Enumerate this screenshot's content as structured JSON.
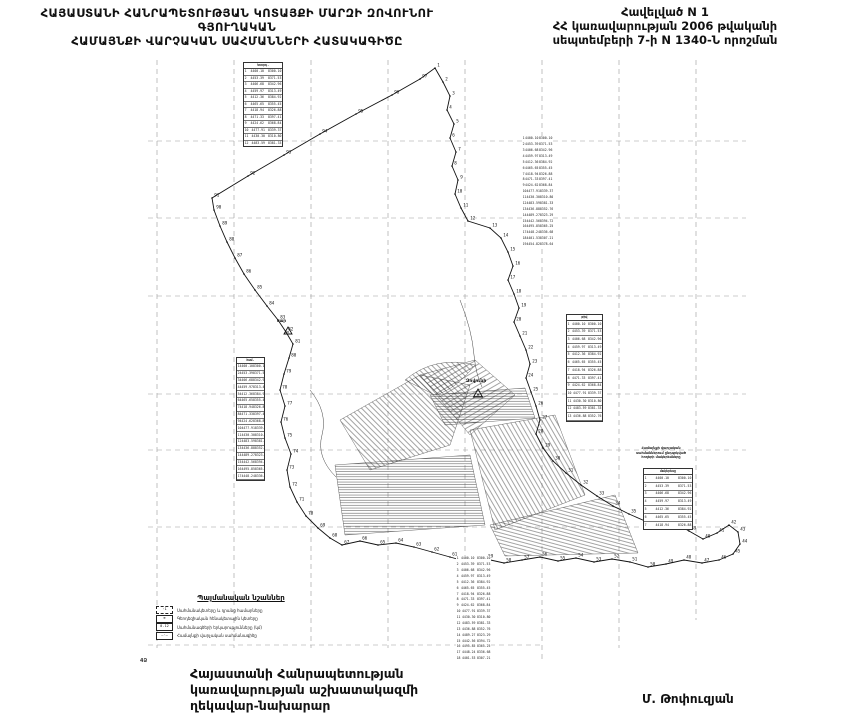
{
  "document": {
    "titles": {
      "left_line1": "ՀԱՅԱՍՏԱՆԻ ՀԱՆՐԱՊԵՏՈՒԹՅԱՆ ԿՈՏԱՅՔԻ ՄԱՐԶԻ ԶՈՎՈՒՆՈՒ ԳՅՈՒՂԱԿԱՆ",
      "left_line2": "ՀԱՄԱՅՆՔԻ ՎԱՐՉԱԿԱՆ ՍԱՀՄԱՆՆԵՐԻ ՀԱՏԱԿԱԳԻԾԸ",
      "right_line1": "Հավելված N 1",
      "right_line2": "ՀՀ կառավարության 2006 թվականի",
      "right_line3": "սեպտեմբերի 7-ի  N 1340-Ն որոշման"
    },
    "footer": {
      "left_line1": "Հայաստանի Հանրապետության",
      "left_line2": "կառավարության աշխատակազմի",
      "left_line3": "ղեկավար-նախարար",
      "signature": "Մ. Թոփուզյան"
    },
    "corner_mark": "4Ձ"
  },
  "legend": {
    "title": "Պայմանական նշաններ",
    "items": [
      {
        "symbol": "boundary-point-box",
        "sample": "·1",
        "label": "Սահմանակետերը և դրանց համարները"
      },
      {
        "symbol": "geodetic-point",
        "sample": "⊕",
        "label": "Գեոդեզիական հենակետային կետերը"
      },
      {
        "symbol": "segment-length",
        "sample": "0.12",
        "label": "Սահմանագծերի երկարությունները (կմ)"
      },
      {
        "symbol": "boundary-line",
        "sample": "—·—",
        "label": "Համայնքի վարչական սահմանագիծը"
      }
    ]
  },
  "map": {
    "settlement_label": "Զովունի",
    "benchmark_label": "սար",
    "note_lines": [
      "Համայնքի վարչական",
      "սահմաններում ընդգրկված",
      "հողերի մակերեսները"
    ],
    "colors": {
      "ink": "#111111",
      "grid": "#9a9a9a"
    },
    "tables": [
      {
        "name": "coord-table-north",
        "x": 243,
        "y": 62,
        "w": 38,
        "h": 83,
        "rows": 14,
        "bordered": true,
        "header": "Կոորդ.",
        "caption": "Զովունի"
      },
      {
        "name": "coord-list-northeast",
        "x": 522,
        "y": 136,
        "w": 31,
        "h": 112,
        "rows": 19,
        "bordered": false,
        "header": "",
        "caption": "ցուցակ"
      },
      {
        "name": "coord-table-east",
        "x": 566,
        "y": 314,
        "w": 35,
        "h": 106,
        "rows": 15,
        "bordered": true,
        "header": "թիվ",
        "caption": "ցուցակ"
      },
      {
        "name": "coord-table-west",
        "x": 236,
        "y": 357,
        "w": 27,
        "h": 122,
        "rows": 20,
        "bordered": true,
        "header": "համ.",
        "caption": "ցուցակ"
      },
      {
        "name": "coord-list-south",
        "x": 456,
        "y": 556,
        "w": 35,
        "h": 106,
        "rows": 18,
        "bordered": false,
        "header": "",
        "caption": ""
      },
      {
        "name": "area-table-southeast",
        "x": 643,
        "y": 468,
        "w": 48,
        "h": 60,
        "rows": 8,
        "bordered": true,
        "header": "մակերեսը",
        "caption": ""
      }
    ],
    "boundary_points": [
      {
        "n": 1,
        "x": 435,
        "y": 68
      },
      {
        "n": 2,
        "x": 443,
        "y": 82
      },
      {
        "n": 3,
        "x": 450,
        "y": 96
      },
      {
        "n": 4,
        "x": 447,
        "y": 110
      },
      {
        "n": 5,
        "x": 454,
        "y": 124
      },
      {
        "n": 6,
        "x": 450,
        "y": 138
      },
      {
        "n": 7,
        "x": 456,
        "y": 152
      },
      {
        "n": 8,
        "x": 452,
        "y": 166
      },
      {
        "n": 9,
        "x": 458,
        "y": 180
      },
      {
        "n": 10,
        "x": 455,
        "y": 194
      },
      {
        "n": 11,
        "x": 461,
        "y": 208
      },
      {
        "n": 12,
        "x": 468,
        "y": 221
      },
      {
        "n": 13,
        "x": 490,
        "y": 228
      },
      {
        "n": 14,
        "x": 501,
        "y": 238
      },
      {
        "n": 15,
        "x": 508,
        "y": 252
      },
      {
        "n": 16,
        "x": 513,
        "y": 266
      },
      {
        "n": 17,
        "x": 508,
        "y": 280
      },
      {
        "n": 18,
        "x": 514,
        "y": 294
      },
      {
        "n": 19,
        "x": 519,
        "y": 308
      },
      {
        "n": 20,
        "x": 514,
        "y": 322
      },
      {
        "n": 21,
        "x": 520,
        "y": 336
      },
      {
        "n": 22,
        "x": 526,
        "y": 350
      },
      {
        "n": 23,
        "x": 530,
        "y": 364
      },
      {
        "n": 24,
        "x": 526,
        "y": 378
      },
      {
        "n": 25,
        "x": 531,
        "y": 392
      },
      {
        "n": 26,
        "x": 536,
        "y": 406
      },
      {
        "n": 27,
        "x": 540,
        "y": 420
      },
      {
        "n": 28,
        "x": 536,
        "y": 434
      },
      {
        "n": 29,
        "x": 543,
        "y": 448
      },
      {
        "n": 30,
        "x": 553,
        "y": 461
      },
      {
        "n": 31,
        "x": 566,
        "y": 473
      },
      {
        "n": 32,
        "x": 581,
        "y": 485
      },
      {
        "n": 33,
        "x": 597,
        "y": 496
      },
      {
        "n": 34,
        "x": 613,
        "y": 506
      },
      {
        "n": 35,
        "x": 629,
        "y": 514
      },
      {
        "n": 36,
        "x": 645,
        "y": 521
      },
      {
        "n": 37,
        "x": 661,
        "y": 527
      },
      {
        "n": 38,
        "x": 675,
        "y": 523
      },
      {
        "n": 39,
        "x": 689,
        "y": 531
      },
      {
        "n": 40,
        "x": 703,
        "y": 539
      },
      {
        "n": 41,
        "x": 717,
        "y": 533
      },
      {
        "n": 42,
        "x": 729,
        "y": 525
      },
      {
        "n": 43,
        "x": 738,
        "y": 532
      },
      {
        "n": 44,
        "x": 740,
        "y": 544
      },
      {
        "n": 45,
        "x": 733,
        "y": 554
      },
      {
        "n": 46,
        "x": 719,
        "y": 560
      },
      {
        "n": 47,
        "x": 702,
        "y": 563
      },
      {
        "n": 48,
        "x": 684,
        "y": 560
      },
      {
        "n": 49,
        "x": 666,
        "y": 564
      },
      {
        "n": 50,
        "x": 648,
        "y": 567
      },
      {
        "n": 51,
        "x": 630,
        "y": 562
      },
      {
        "n": 52,
        "x": 612,
        "y": 559
      },
      {
        "n": 53,
        "x": 594,
        "y": 562
      },
      {
        "n": 54,
        "x": 576,
        "y": 558
      },
      {
        "n": 55,
        "x": 558,
        "y": 561
      },
      {
        "n": 56,
        "x": 540,
        "y": 557
      },
      {
        "n": 57,
        "x": 522,
        "y": 560
      },
      {
        "n": 58,
        "x": 504,
        "y": 563
      },
      {
        "n": 59,
        "x": 486,
        "y": 559
      },
      {
        "n": 60,
        "x": 468,
        "y": 562
      },
      {
        "n": 61,
        "x": 450,
        "y": 557
      },
      {
        "n": 62,
        "x": 432,
        "y": 552
      },
      {
        "n": 63,
        "x": 414,
        "y": 547
      },
      {
        "n": 64,
        "x": 396,
        "y": 543
      },
      {
        "n": 65,
        "x": 378,
        "y": 545
      },
      {
        "n": 66,
        "x": 360,
        "y": 541
      },
      {
        "n": 67,
        "x": 342,
        "y": 545
      },
      {
        "n": 68,
        "x": 330,
        "y": 538
      },
      {
        "n": 69,
        "x": 318,
        "y": 528
      },
      {
        "n": 70,
        "x": 306,
        "y": 516
      },
      {
        "n": 71,
        "x": 297,
        "y": 502
      },
      {
        "n": 72,
        "x": 290,
        "y": 487
      },
      {
        "n": 73,
        "x": 287,
        "y": 470
      },
      {
        "n": 74,
        "x": 291,
        "y": 454
      },
      {
        "n": 75,
        "x": 285,
        "y": 438
      },
      {
        "n": 76,
        "x": 281,
        "y": 422
      },
      {
        "n": 77,
        "x": 285,
        "y": 406
      },
      {
        "n": 78,
        "x": 280,
        "y": 390
      },
      {
        "n": 79,
        "x": 284,
        "y": 374
      },
      {
        "n": 80,
        "x": 289,
        "y": 358
      },
      {
        "n": 81,
        "x": 293,
        "y": 344
      },
      {
        "n": 82,
        "x": 286,
        "y": 332
      },
      {
        "n": 83,
        "x": 278,
        "y": 320
      },
      {
        "n": 84,
        "x": 267,
        "y": 306
      },
      {
        "n": 85,
        "x": 255,
        "y": 290
      },
      {
        "n": 86,
        "x": 244,
        "y": 274
      },
      {
        "n": 87,
        "x": 235,
        "y": 258
      },
      {
        "n": 88,
        "x": 227,
        "y": 242
      },
      {
        "n": 89,
        "x": 220,
        "y": 226
      },
      {
        "n": 90,
        "x": 214,
        "y": 210
      },
      {
        "n": 91,
        "x": 212,
        "y": 198
      },
      {
        "n": 92,
        "x": 248,
        "y": 176
      },
      {
        "n": 93,
        "x": 284,
        "y": 155
      },
      {
        "n": 94,
        "x": 320,
        "y": 134
      },
      {
        "n": 95,
        "x": 356,
        "y": 114
      },
      {
        "n": 96,
        "x": 392,
        "y": 95
      },
      {
        "n": 97,
        "x": 420,
        "y": 79
      }
    ]
  }
}
